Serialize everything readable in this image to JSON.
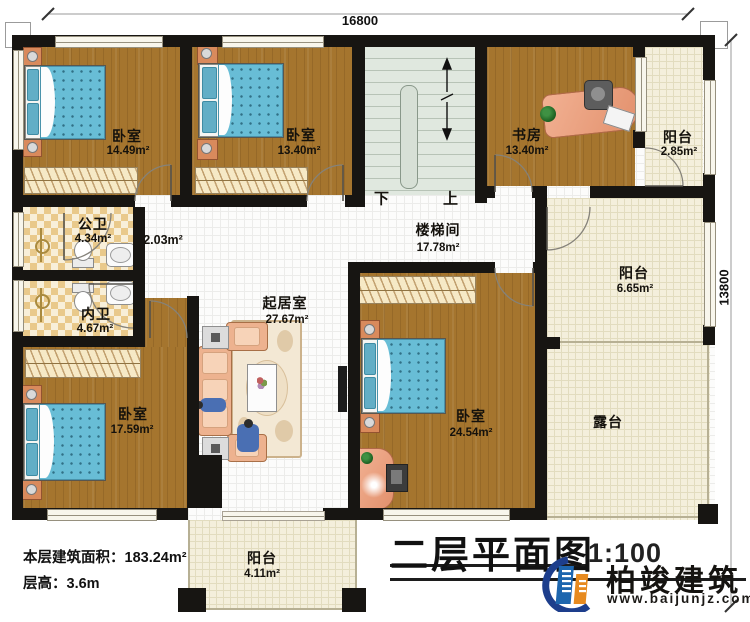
{
  "dimensions": {
    "top": "16800",
    "right": "13800"
  },
  "rooms": {
    "bedroom_tl": {
      "name": "卧室",
      "area": "14.49m²"
    },
    "bedroom_tm": {
      "name": "卧室",
      "area": "13.40m²"
    },
    "study": {
      "name": "书房",
      "area": "13.40m²"
    },
    "balcony_tr": {
      "name": "阳台",
      "area": "2.85m²"
    },
    "stair_hall": {
      "name": "楼梯间",
      "area": "17.78m²"
    },
    "corridor": {
      "area": "2.03m²"
    },
    "public_bath": {
      "name": "公卫",
      "area": "4.34m²"
    },
    "private_bath": {
      "name": "内卫",
      "area": "4.67m²"
    },
    "living_room": {
      "name": "起居室",
      "area": "27.67m²"
    },
    "balcony_r": {
      "name": "阳台",
      "area": "6.65m²"
    },
    "bedroom_bl": {
      "name": "卧室",
      "area": "17.59m²"
    },
    "bedroom_br": {
      "name": "卧室",
      "area": "24.54m²"
    },
    "terrace": {
      "name": "露台"
    },
    "balcony_b": {
      "name": "阳台",
      "area": "4.11m²"
    }
  },
  "stairs": {
    "down": "下",
    "up": "上"
  },
  "notes": {
    "floor_area": "本层建筑面积：183.24m²",
    "floor_height": "层高：3.6m"
  },
  "title_block": {
    "title": "二层平面图",
    "scale": "1:100"
  },
  "brand": {
    "name": "柏竣建筑",
    "website": "www.baijunjz.com"
  },
  "colors": {
    "wall": "#171512",
    "wood": "#a5752e",
    "cream_tile": "#f4efdc",
    "bath_tile": "#e9c98b",
    "stair": "#e0e8df",
    "bed_blue": "#68bdd6",
    "sofa_salmon": "#edb28f",
    "brand_blue": "#1e66ae",
    "brand_navy": "#1d3e8c",
    "brand_orange": "#e78a1f"
  }
}
